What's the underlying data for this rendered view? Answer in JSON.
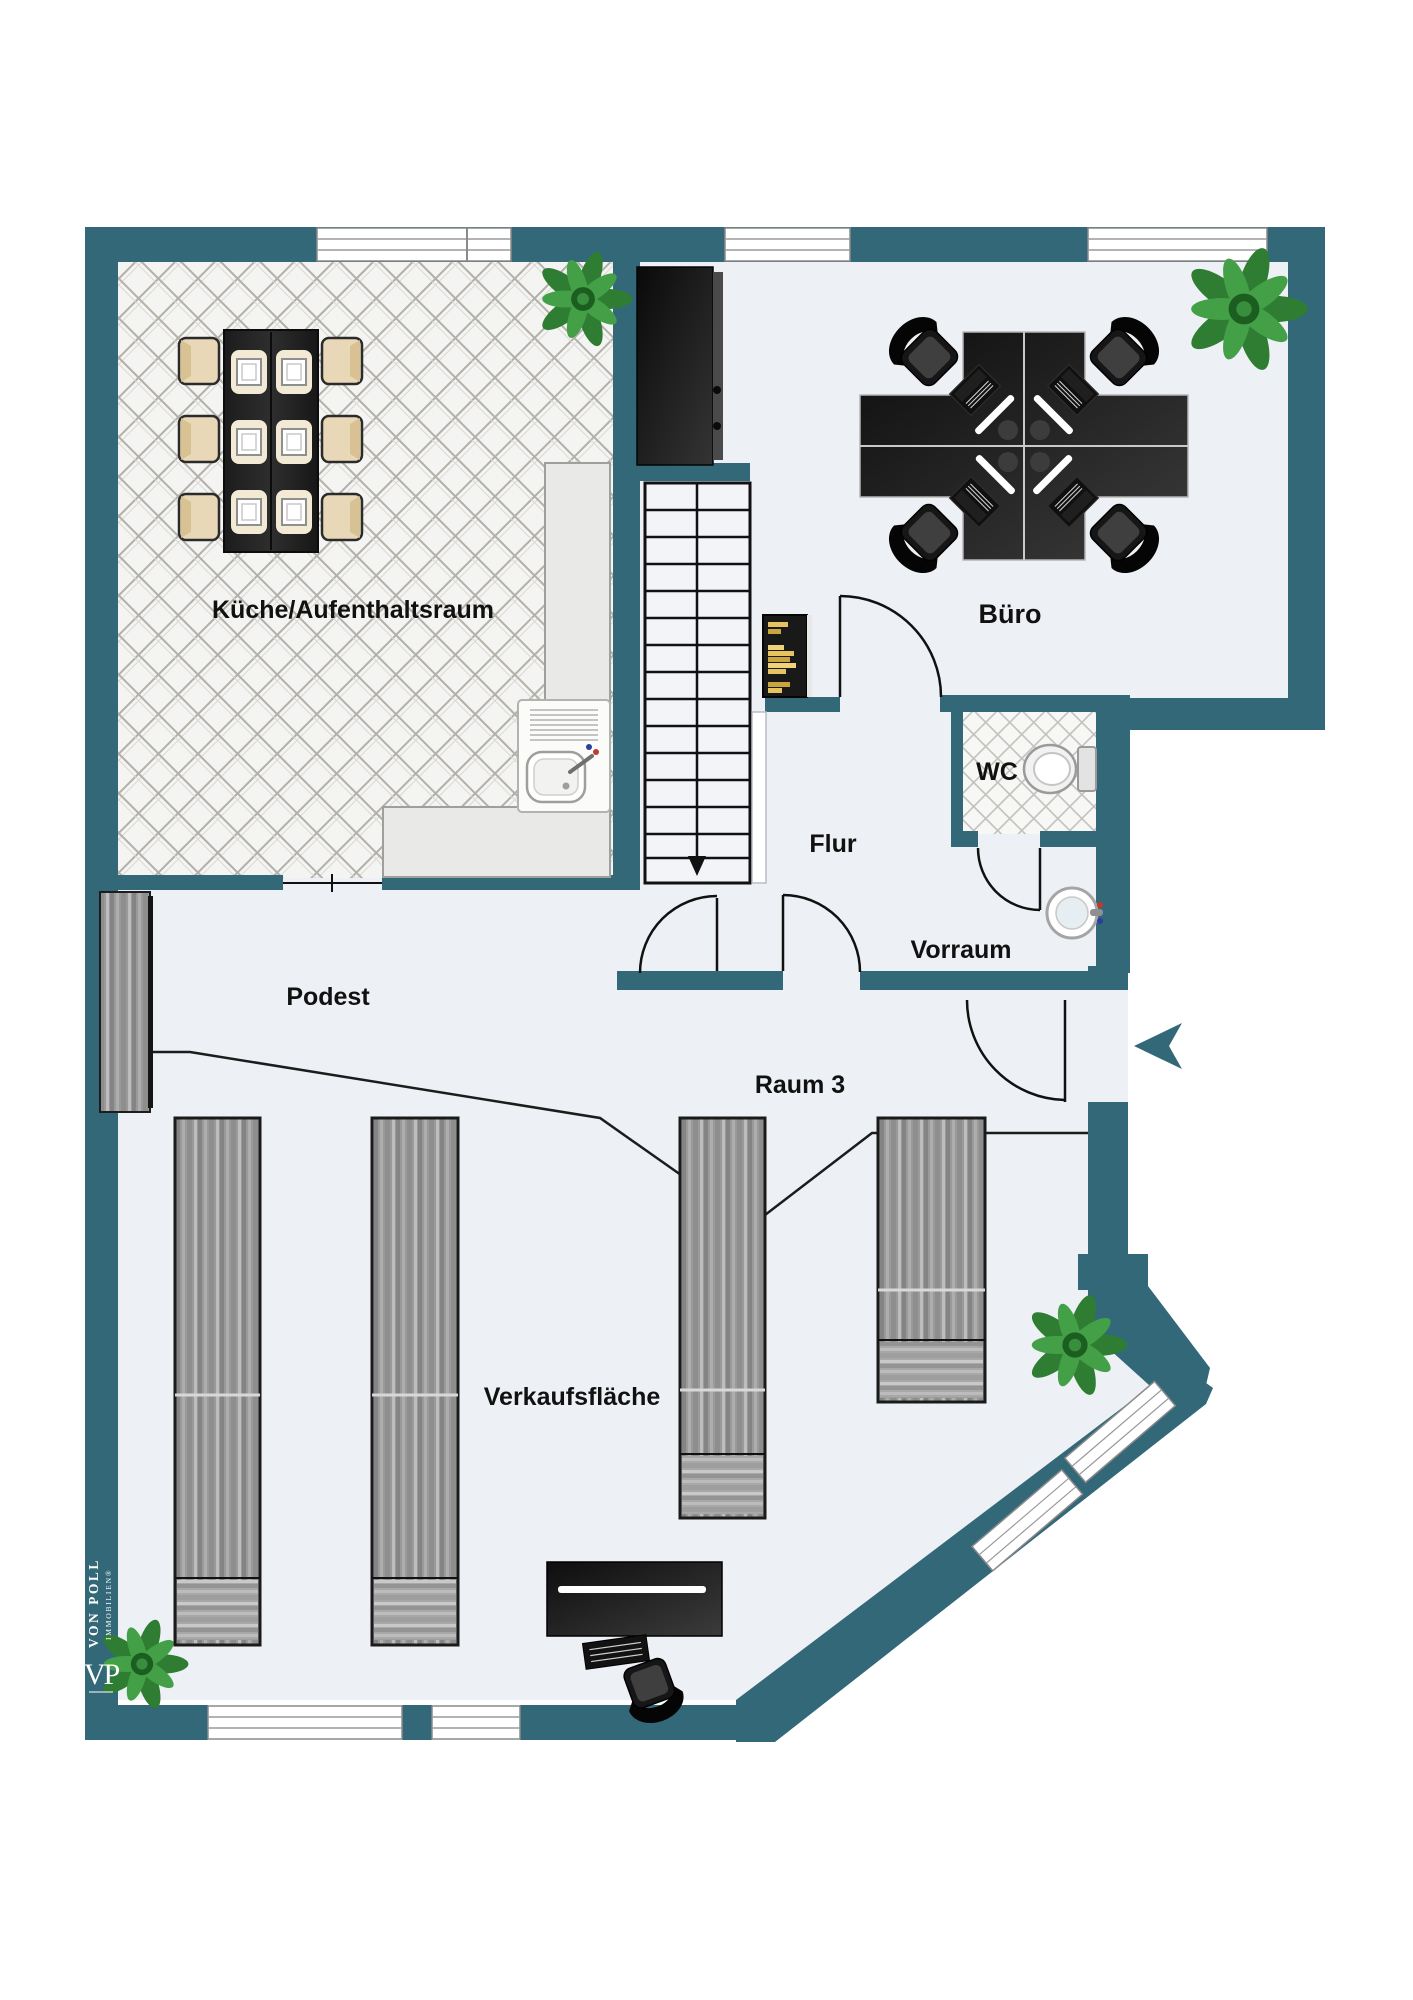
{
  "rooms": {
    "kitchen": {
      "label": "Küche/Aufenthaltsraum"
    },
    "office": {
      "label": "Büro"
    },
    "wc": {
      "label": "WC"
    },
    "hallway": {
      "label": "Flur"
    },
    "anteroom": {
      "label": "Vorraum"
    },
    "platform": {
      "label": "Podest"
    },
    "room3": {
      "label": "Raum 3"
    },
    "sales": {
      "label": "Verkaufsfläche"
    }
  },
  "branding": {
    "monogram": "VP",
    "company": "VON POLL",
    "division": "IMMOBILIEN®"
  },
  "colors": {
    "wall": "#336879",
    "floor": "#edf0f4",
    "tile_grout": "#b3b0aa",
    "furniture_dark": "#1a1a1a",
    "chair_cream": "#e9d8b8",
    "book_gold": "#e7c35f",
    "plant_green": "#3a8a3f",
    "wood_gray": "#9a9a9a"
  },
  "icons": {
    "entrance_arrow": "left-pointing chevron marking the entrance",
    "stair_arrow": "downward run-direction arrow on staircase"
  }
}
